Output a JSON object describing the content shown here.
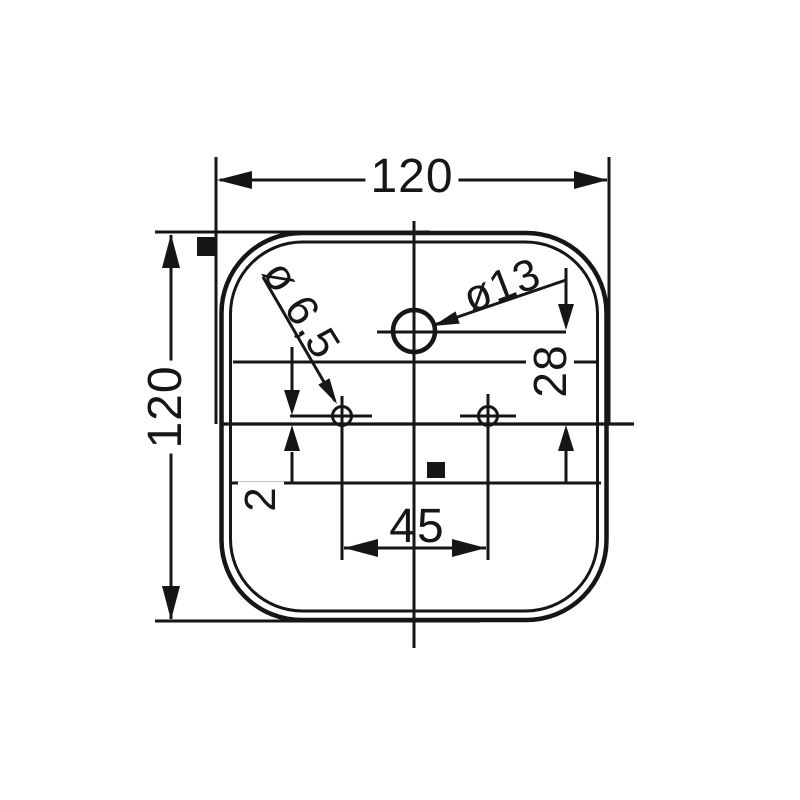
{
  "meta": {
    "drawing_type": "lamp lens mounting dimensions",
    "ink_color": "#161616",
    "background_color": "#ffffff"
  },
  "dimensions": {
    "width_top": "120",
    "height_left": "120",
    "hole_center_spacing": "45",
    "large_hole_vertical_offset": "28",
    "small_hole_vertical_offset": "2",
    "large_hole_diameter": "ø13",
    "small_hole_diameter": "ø 6,5"
  }
}
